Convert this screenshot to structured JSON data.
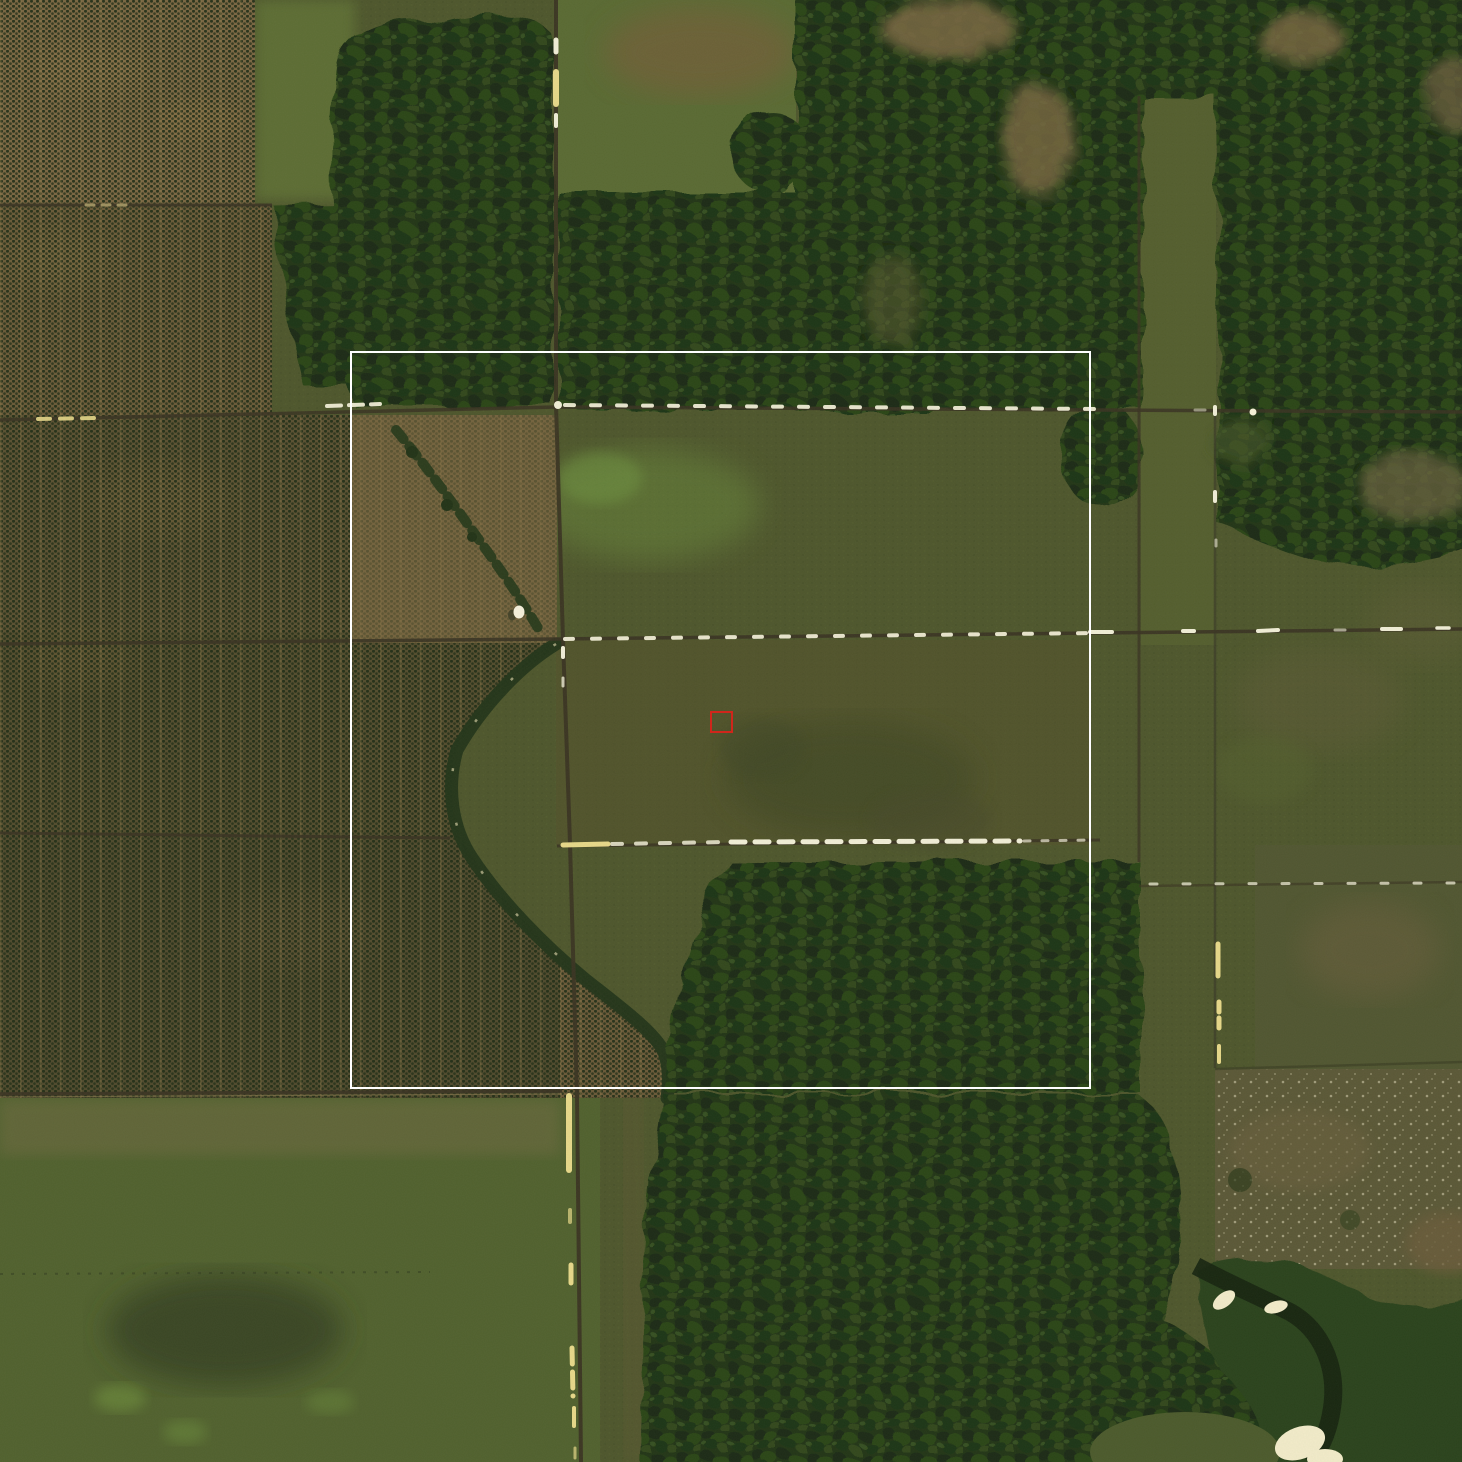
{
  "image": {
    "width": 1462,
    "height": 1462,
    "kind": "satellite-aerial-photo"
  },
  "scene": {
    "description": "Satellite view of plantation plots with tree rows (west), dark forest blocks (north, northeast and south-center), olive grassland clearings, a grid of dirt tracks with bright sandy patches, a meandering riparian tree line, a small white structure, and stream pools with bright sand in the southeast",
    "background_color": "#4e562c"
  },
  "palette": {
    "grass_base": "#4e562c",
    "grass_light": "#5a6a33",
    "grass_bright": "#6c8c3e",
    "grass_bottom": "#51612e",
    "smudge_dark": "#3e4424",
    "plantation_soil": "#6a5938",
    "plantation_soil_light": "#7c6944",
    "plantation_strip_dark": "#4a472a",
    "bare_brown": "#76643e",
    "palm_dot": "#1f2c15",
    "forest_base": "#223618",
    "forest_shadow": "#1a2c12",
    "forest_light": "#2c4419",
    "scrub_brown": "#6b5f3c",
    "sandy_field": "#5b5837",
    "dry_patch": "#7a6842",
    "road_dark": "#3a3322",
    "road_bright": "#f2efd8",
    "road_gold": "#e8d98a",
    "riparian_dark": "#233519",
    "stream_dark": "#16240f",
    "water_sand": "#f3ecca",
    "white_structure": "#f6f1dc"
  },
  "overlays": {
    "annotation_box": {
      "x": 350,
      "y": 351,
      "width": 741,
      "height": 738,
      "border_px": 2,
      "color": "#ffffff"
    },
    "marker_box": {
      "x": 710,
      "y": 711,
      "width": 23,
      "height": 22,
      "border_px": 2,
      "color": "#d0261b"
    }
  }
}
